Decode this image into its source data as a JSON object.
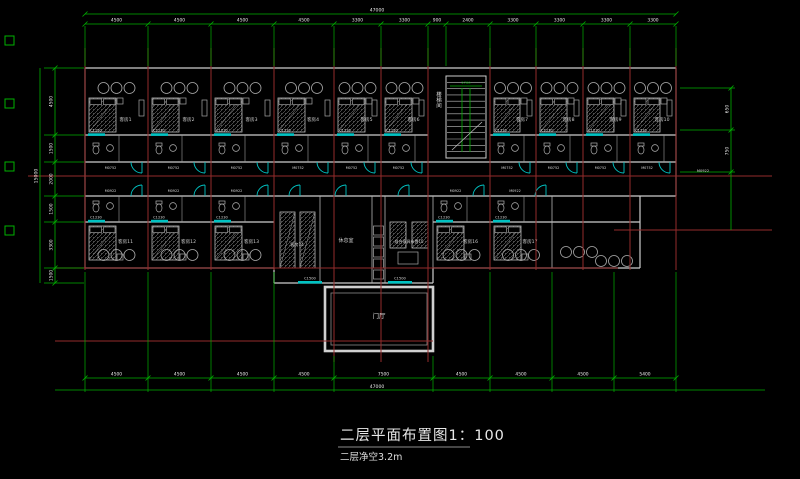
{
  "title": {
    "main": "二层平面布置图1：100",
    "sub": "二层净空3.2m"
  },
  "colors": {
    "background": "#000000",
    "wall": "#cdcdcd",
    "wall_light": "#b5b5b5",
    "grid_red": "#942b2b",
    "dim_green": "#00b200",
    "window_cyan": "#00c2c2",
    "text_light": "#e8e8e8",
    "room_label": "#cfcfcf"
  },
  "labels": {
    "stairwell": "楼梯间",
    "entrance": "门厅",
    "lounge": "休息室",
    "furniture_room": "组合家具布置15",
    "room14": "客房14",
    "window_top": "C1230",
    "window_bottom": "C1500",
    "door_top": "M0752",
    "door_bottom": "M0922",
    "door_right": "M0922",
    "stair_dim": "2700"
  },
  "rooms": {
    "top": [
      {
        "label": "客房1",
        "x": 85,
        "w": 63
      },
      {
        "label": "客房2",
        "x": 148,
        "w": 63
      },
      {
        "label": "客房3",
        "x": 211,
        "w": 63
      },
      {
        "label": "客房4",
        "x": 274,
        "w": 60
      },
      {
        "label": "客房5",
        "x": 334,
        "w": 47
      },
      {
        "label": "客房6",
        "x": 381,
        "w": 47
      },
      {
        "label": "客房7",
        "x": 490,
        "w": 46
      },
      {
        "label": "客房8",
        "x": 536,
        "w": 47
      },
      {
        "label": "客房9",
        "x": 583,
        "w": 47
      },
      {
        "label": "客房10",
        "x": 630,
        "w": 46
      }
    ],
    "bottom": [
      {
        "label": "客房11",
        "x": 85,
        "w": 63
      },
      {
        "label": "客房12",
        "x": 148,
        "w": 63
      },
      {
        "label": "客房13",
        "x": 211,
        "w": 63
      },
      {
        "label": "客房16",
        "x": 433,
        "w": 57
      },
      {
        "label": "客房17",
        "x": 490,
        "w": 62
      }
    ]
  },
  "dimensions": {
    "top": {
      "overall": "47000",
      "ticks": [
        85,
        148,
        211,
        274,
        334,
        381,
        428,
        446,
        490,
        536,
        583,
        630,
        676
      ],
      "labels": [
        "4500",
        "4500",
        "4500",
        "4500",
        "3300",
        "3300",
        "900",
        "2400",
        "3300",
        "3300",
        "3300",
        "3300"
      ]
    },
    "bottom": {
      "overall": "47000",
      "ticks": [
        85,
        148,
        211,
        274,
        334,
        433,
        490,
        552,
        614,
        676
      ],
      "labels": [
        "4500",
        "4500",
        "4500",
        "4500",
        "7500",
        "4500",
        "4500",
        "4500",
        "5400"
      ]
    },
    "left": {
      "overall": "15000",
      "ticks": [
        68,
        135,
        162,
        196,
        222,
        268,
        283
      ],
      "labels": [
        "4500",
        "1500",
        "2000",
        "1500",
        "3300",
        "1500"
      ]
    },
    "right": {
      "ticks": [
        88,
        130,
        172
      ],
      "labels": [
        "650",
        "750"
      ]
    }
  }
}
